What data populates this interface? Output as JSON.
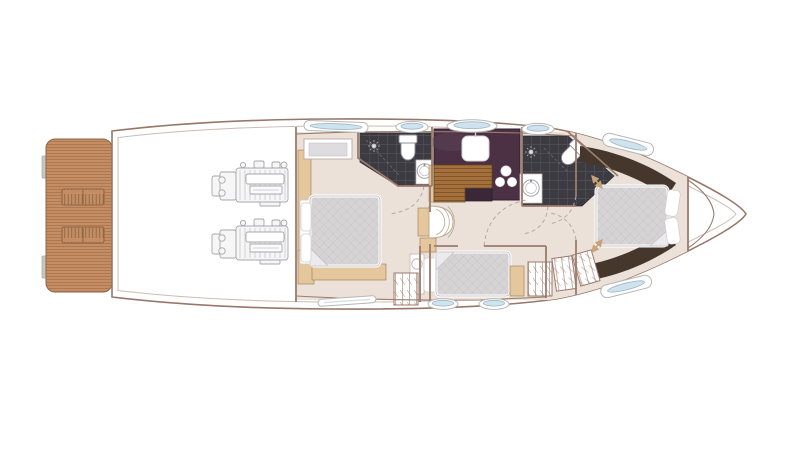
{
  "document_title": "",
  "colors": {
    "hull": "#96776a",
    "hull-inner": "#cbbcb2",
    "wall": "#9b7b6c",
    "floor": "#ece1d8",
    "wood": "#e4c79c",
    "wood-edge": "#a9875f",
    "teak": "#c58d63",
    "teak-stripe": "#aa744b",
    "grate": "#8d6647",
    "wood-floor": "#a4713c",
    "wood-slat": "#7e5529",
    "bath": "#3c3b41",
    "bath-grid": "#55545c",
    "galley": "#4b3143",
    "galley-edge": "#30202e",
    "bed": "#d6d3d5",
    "bed-line": "#c5c2c5",
    "espresso": "#46372c",
    "glass": "#cfe3ee",
    "glass-rim": "#9fb4c2",
    "win-edge": "#b6b6b6",
    "engine": "#a7a7a9",
    "arc": "#b7a99e",
    "arrow": "#c9a377",
    "fixture": "#8f8f94"
  },
  "regions": [
    {
      "id": "swim-platform",
      "label": "Teak swim platform with two deck hatches"
    },
    {
      "id": "engine-room",
      "label": "Engine room with twin engines"
    },
    {
      "id": "aft-cabin",
      "label": "Aft cabin with double bed"
    },
    {
      "id": "aft-bathroom",
      "label": "Aft bathroom with shower, toilet and basin"
    },
    {
      "id": "galley",
      "label": "Galley with sink, hob and wood floor"
    },
    {
      "id": "day-bathroom",
      "label": "Forward bathroom with shower, angled toilet and basin"
    },
    {
      "id": "staircase",
      "label": "Companionway stairs"
    },
    {
      "id": "guest-cabin",
      "label": "Guest cabin with single berth and wardrobe"
    },
    {
      "id": "forward-cabin",
      "label": "Forward master cabin with island double bed"
    },
    {
      "id": "bow-locker",
      "label": "Bow anchor locker"
    },
    {
      "id": "windows",
      "label": "Hull windows and portholes"
    }
  ]
}
